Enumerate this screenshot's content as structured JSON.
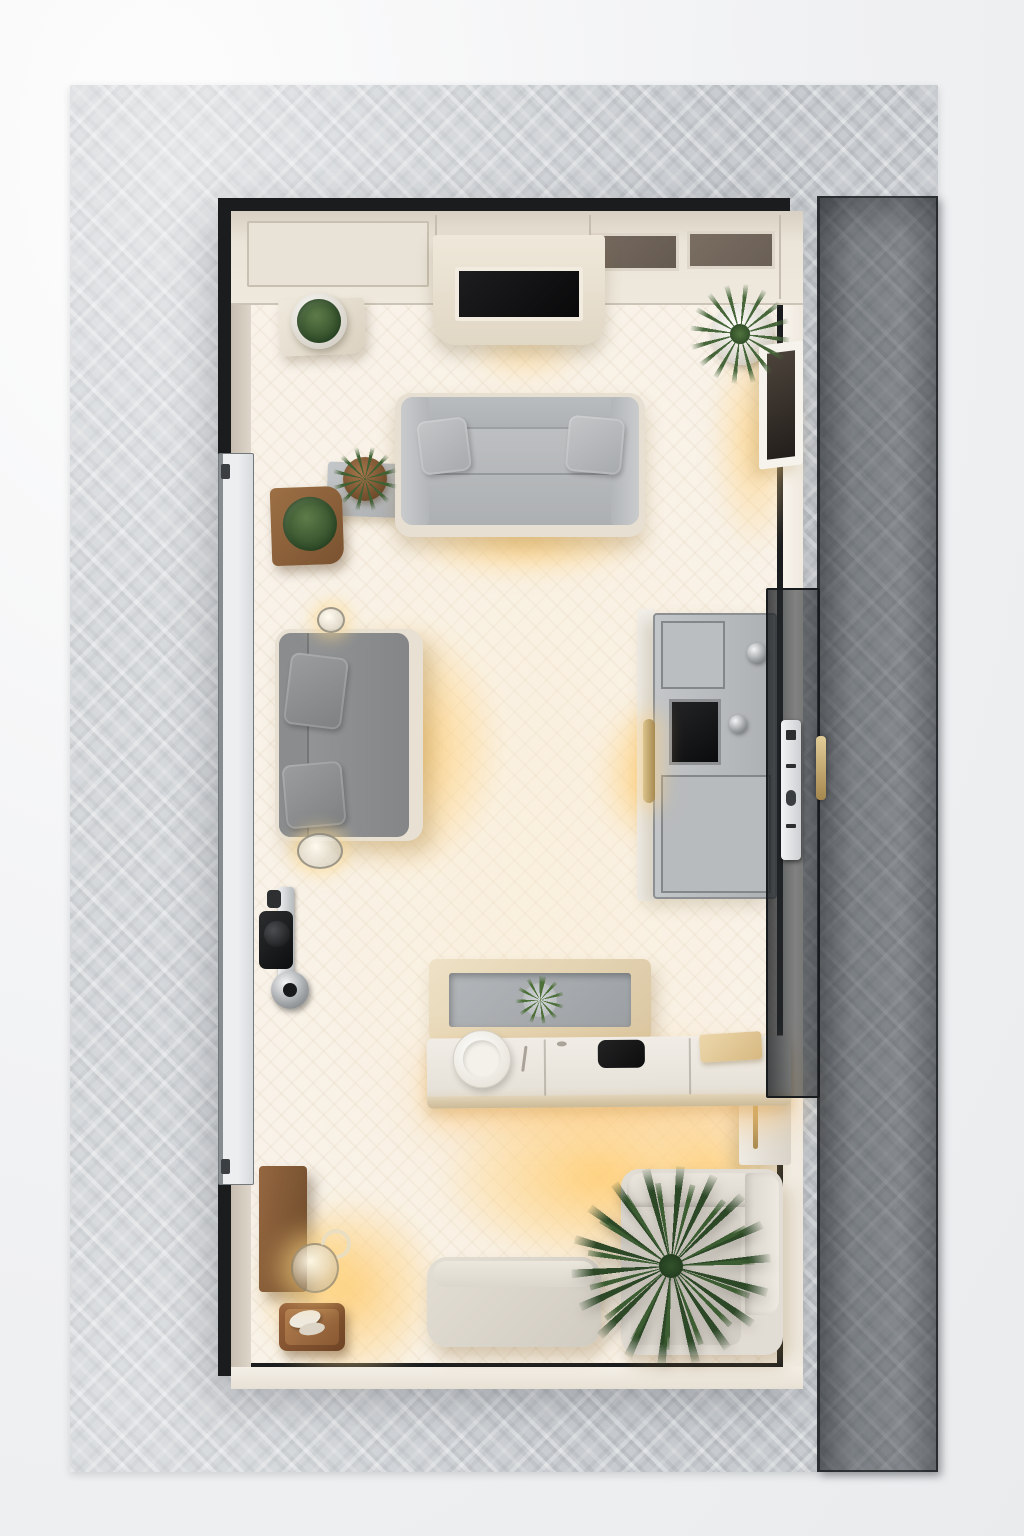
{
  "scene": {
    "description": "Photorealistic top-down 3D render of a miniature furnished room (living area with kitchenette) standing on a gray woven mat; warm accent lighting glows around the furniture; a tall tinted glass wall panel lies open along the right side of the black-framed room shell.",
    "style": "top-down interior render",
    "contains_text": false
  },
  "palette": {
    "background": "#f0f1f3",
    "mat": "#c8ccd0",
    "room_frame": "#1a1c1e",
    "floor": "#f8f2e9",
    "wall_beige": "#d5cbbe",
    "glow_warm": "#ffce7d",
    "sofa_light_gray": "#b9bcbe",
    "sofa_dark_gray": "#8e9092",
    "upholstery_cream": "#e2ddd4",
    "cabinet_cream": "#e9e3d7",
    "kitchen_gray": "#b5b8bb",
    "wood": "#8a5b35",
    "plant_green": "#3a5c33",
    "glass_tint": "rgba(40,44,48,0.6)",
    "brass": "#c3a768"
  },
  "objects": {
    "mat": {
      "label": "gray woven mat"
    },
    "glass_panel": {
      "label": "tinted glass wall panel, open along right side"
    },
    "glass_hinge_panel": {
      "label": "tinted glass door leaf at right wall"
    },
    "door_control_strip": {
      "label": "white door control strip with buttons"
    },
    "door_handle": {
      "label": "brass door handle"
    },
    "room": {
      "label": "black-framed room shell"
    },
    "ceiling_cabinets": {
      "label": "cream ceiling cabinet row"
    },
    "vent_panel_1": {
      "label": "dark recessed ceiling panel"
    },
    "vent_panel_2": {
      "label": "dark recessed ceiling panel"
    },
    "tv_unit": {
      "label": "drop-down TV unit with black screen"
    },
    "corner_shelf": {
      "label": "cream corner shelf"
    },
    "potted_bush_top_left": {
      "label": "round bush in white pot"
    },
    "potted_plant_top_right": {
      "label": "spiky plant in white pot"
    },
    "wall_frame": {
      "label": "framed dark screen on right wall"
    },
    "sofa_top": {
      "label": "light gray two-seat sofa with two cushions"
    },
    "sofa_left": {
      "label": "dark gray sofa along left wall with two cushions"
    },
    "side_ledge": {
      "label": "gray side ledge"
    },
    "side_plant": {
      "label": "small plant in brown pot"
    },
    "planter_box": {
      "label": "wooden planter box with bush"
    },
    "entry_door": {
      "label": "white entry door on left wall"
    },
    "door_lock": {
      "label": "black and chrome door lock hardware"
    },
    "sconce_glass_upper": {
      "label": "small glass wall light"
    },
    "sconce_glass_lower": {
      "label": "glass jar wall light"
    },
    "kitchen_unit": {
      "label": "gray tall kitchen unit"
    },
    "oven_screen": {
      "label": "black oven front panel"
    },
    "knob_upper": {
      "label": "chrome knob"
    },
    "knob_lower": {
      "label": "chrome knob"
    },
    "brass_sconce": {
      "label": "brass wall light bar"
    },
    "console_table": {
      "label": "tan console table with gray inset"
    },
    "console_plant": {
      "label": "small green plant on console"
    },
    "counter": {
      "label": "floating breakfast counter"
    },
    "plate": {
      "label": "white plate"
    },
    "cooktop": {
      "label": "black cooktop inset"
    },
    "serving_board": {
      "label": "wooden serving board"
    },
    "wall_cabinet": {
      "label": "wall cabinet with brass handle"
    },
    "armchair": {
      "label": "cream armchair"
    },
    "palm_plant": {
      "label": "large dark green palm plant"
    },
    "ottoman": {
      "label": "cream ottoman bench"
    },
    "wood_panel": {
      "label": "wooden wall board"
    },
    "pendant_lamp": {
      "label": "glowing glass pendant lamp"
    },
    "tray": {
      "label": "wooden tray with dishes"
    },
    "glow": {
      "label": "warm accent light glow"
    }
  }
}
